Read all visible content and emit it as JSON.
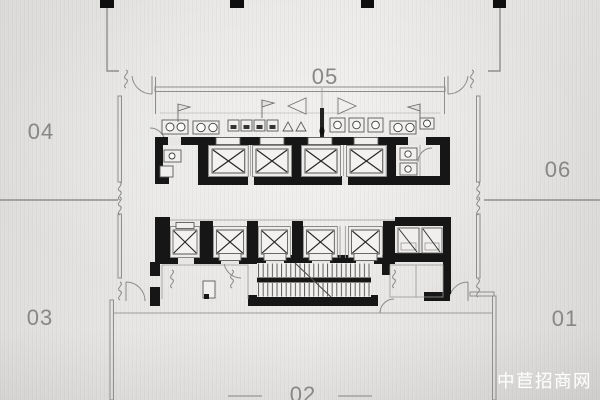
{
  "image_type": "office-tower-core-floor-plan",
  "units": {
    "u01": {
      "label": "01"
    },
    "u02": {
      "label": "02"
    },
    "u03": {
      "label": "03"
    },
    "u04": {
      "label": "04"
    },
    "u05": {
      "label": "05"
    },
    "u06": {
      "label": "06"
    }
  },
  "core": {
    "upper_elevator_count": 4,
    "middle_elevator_count": 5,
    "has_scissor_stair": true,
    "has_washrooms": true,
    "has_service_shafts": true
  },
  "watermark": {
    "text": "中苣招商网",
    "color": "#ffffff"
  },
  "colors": {
    "background": "#e6e5e3",
    "wall_black": "#161616",
    "line_gray": "#8e8e8c",
    "label_gray": "#878787"
  }
}
